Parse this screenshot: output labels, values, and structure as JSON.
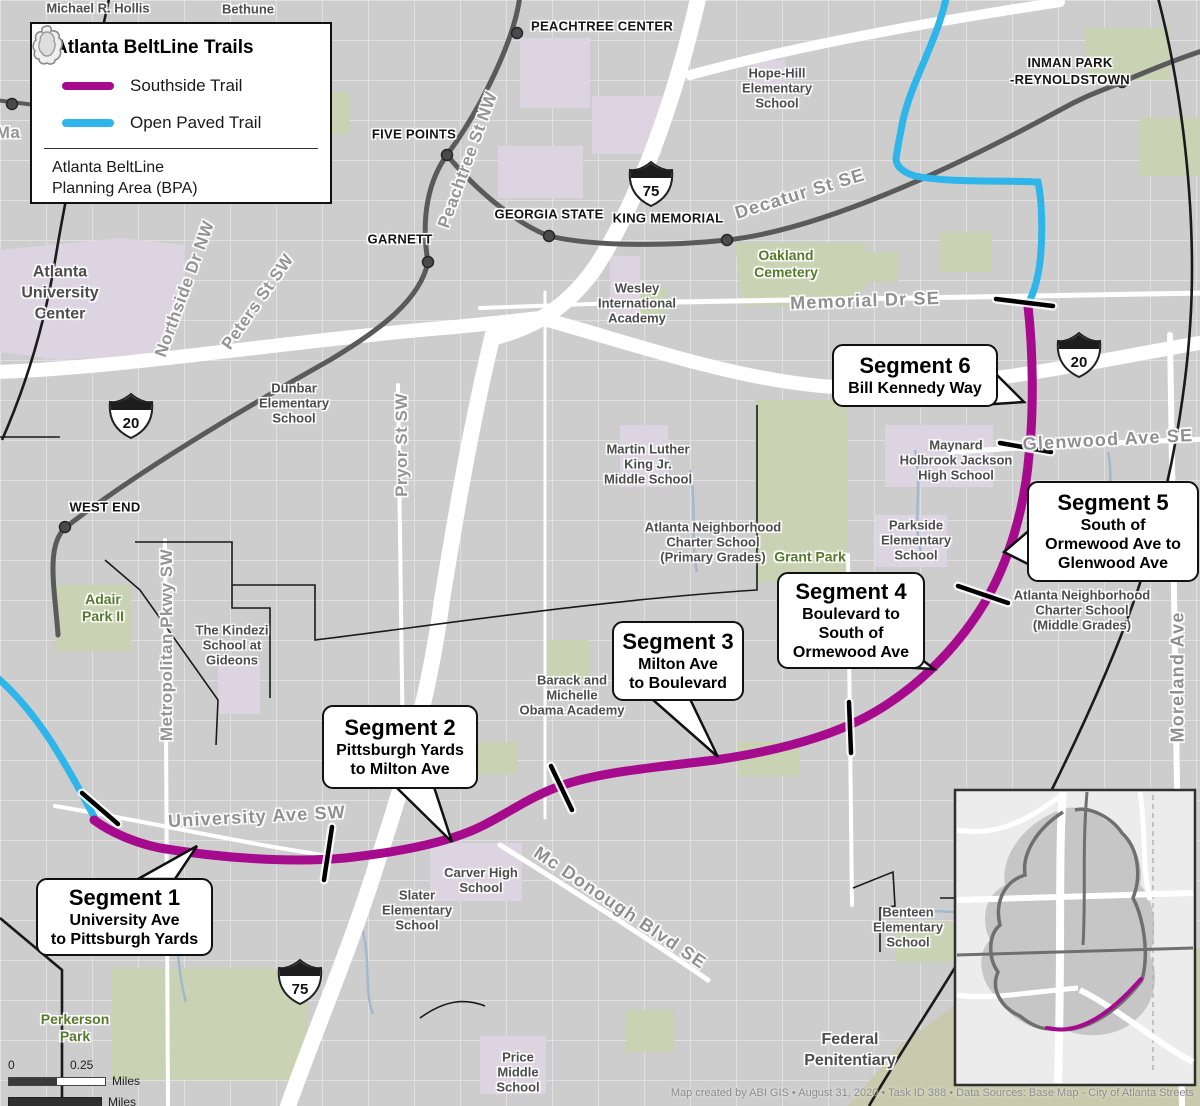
{
  "colors": {
    "magenta": "#a50b8c",
    "cyan": "#2eb6ea",
    "base_gray": "#cdcdcd",
    "lavender": "#ddd4e1",
    "park_green": "#c9d3b3",
    "khaki": "#c9caad",
    "rail_gray": "#5a5a5a",
    "boundary_black": "#1a1a1a",
    "street_label": "#949494",
    "school_label": "#4d4d4d",
    "park_label": "#567a2b",
    "creek_blue": "#a4b8cd"
  },
  "legend": {
    "title": "Atlanta BeltLine Trails",
    "items": [
      {
        "label": "Southside Trail",
        "color": "#a50b8c"
      },
      {
        "label": "Open Paved Trail",
        "color": "#2eb6ea"
      }
    ],
    "bpa_line1": "Atlanta BeltLine",
    "bpa_line2": "Planning Area (BPA)"
  },
  "scalebar": {
    "start": "0",
    "mid": "0.25",
    "unit": "Miles"
  },
  "credits": "Map created by ABI GIS • August 31, 2020 • Task ID 388 • Data Sources: Base Map - City of Atlanta Streets",
  "callouts": [
    {
      "title": "Segment 1",
      "lines": [
        "University Ave",
        "to Pittsburgh Yards"
      ],
      "x": 36,
      "y": 878,
      "w": 177,
      "h": 78,
      "pointer": [
        [
          138,
          879
        ],
        [
          175,
          879
        ],
        [
          197,
          846
        ]
      ]
    },
    {
      "title": "Segment 2",
      "lines": [
        "Pittsburgh Yards",
        "to Milton Ave"
      ],
      "x": 322,
      "y": 705,
      "w": 156,
      "h": 84,
      "pointer": [
        [
          396,
          787
        ],
        [
          434,
          787
        ],
        [
          452,
          842
        ]
      ]
    },
    {
      "title": "Segment 3",
      "lines": [
        "Milton Ave",
        "to Boulevard"
      ],
      "x": 612,
      "y": 621,
      "w": 132,
      "h": 80,
      "pointer": [
        [
          652,
          699
        ],
        [
          690,
          699
        ],
        [
          718,
          757
        ]
      ]
    },
    {
      "title": "Segment 4",
      "lines": [
        "Boulevard to",
        "South of",
        "Ormewood Ave"
      ],
      "x": 777,
      "y": 572,
      "w": 148,
      "h": 97,
      "pointer": [
        [
          878,
          666
        ],
        [
          916,
          655
        ],
        [
          934,
          669
        ]
      ]
    },
    {
      "title": "Segment 5",
      "lines": [
        "South of",
        "Ormewood Ave to",
        "Glenwood Ave"
      ],
      "x": 1027,
      "y": 481,
      "w": 172,
      "h": 101,
      "pointer": [
        [
          1032,
          528
        ],
        [
          1032,
          566
        ],
        [
          1004,
          552
        ]
      ]
    },
    {
      "title": "Segment 6",
      "lines": [
        "Bill Kennedy Way"
      ],
      "x": 832,
      "y": 344,
      "w": 166,
      "h": 63,
      "pointer": [
        [
          994,
          372
        ],
        [
          994,
          404
        ],
        [
          1024,
          402
        ]
      ]
    }
  ],
  "map": {
    "shields": [
      {
        "route": "75",
        "x": 651,
        "y": 183
      },
      {
        "route": "20",
        "x": 131,
        "y": 415
      },
      {
        "route": "20",
        "x": 1079,
        "y": 354
      },
      {
        "route": "75",
        "x": 300,
        "y": 981
      }
    ],
    "stations": [
      [
        517,
        33
      ],
      [
        447,
        155
      ],
      [
        549,
        236
      ],
      [
        727,
        240
      ],
      [
        428,
        262
      ],
      [
        65,
        527
      ],
      [
        1122,
        82
      ],
      [
        12,
        104
      ]
    ],
    "ticks": [
      [
        82,
        793,
        118,
        824
      ],
      [
        332,
        827,
        324,
        880
      ],
      [
        551,
        766,
        572,
        810
      ],
      [
        849,
        702,
        851,
        753
      ],
      [
        958,
        586,
        1008,
        603
      ],
      [
        1000,
        443,
        1051,
        452
      ],
      [
        996,
        299,
        1053,
        306
      ]
    ],
    "labels": [
      {
        "lines": [
          "Michael R. Hollis"
        ],
        "x": 98,
        "y": 8,
        "rot": 0,
        "cls": "school"
      },
      {
        "lines": [
          "Bethune"
        ],
        "x": 248,
        "y": 9,
        "rot": 0,
        "cls": "school"
      },
      {
        "lines": [
          "PEACHTREE CENTER"
        ],
        "x": 602,
        "y": 26,
        "rot": 0,
        "cls": "station"
      },
      {
        "lines": [
          "FIVE POINTS"
        ],
        "x": 414,
        "y": 134,
        "rot": 0,
        "cls": "station"
      },
      {
        "lines": [
          "GARNETT"
        ],
        "x": 400,
        "y": 239,
        "rot": 0,
        "cls": "station"
      },
      {
        "lines": [
          "GEORGIA STATE"
        ],
        "x": 549,
        "y": 214,
        "rot": 0,
        "cls": "station"
      },
      {
        "lines": [
          "KING MEMORIAL"
        ],
        "x": 668,
        "y": 218,
        "rot": 0,
        "cls": "station"
      },
      {
        "lines": [
          "WEST END"
        ],
        "x": 105,
        "y": 507,
        "rot": 0,
        "cls": "station"
      },
      {
        "lines": [
          "INMAN PARK",
          "-REYNOLDSTOWN"
        ],
        "x": 1070,
        "y": 71,
        "rot": 0,
        "cls": "station"
      },
      {
        "lines": [
          "Hope-Hill",
          "Elementary",
          "School"
        ],
        "x": 777,
        "y": 88,
        "rot": 0,
        "cls": "school"
      },
      {
        "lines": [
          "Peachtree St NW"
        ],
        "x": 468,
        "y": 160,
        "rot": -70,
        "cls": "street"
      },
      {
        "lines": [
          "Decatur St SE"
        ],
        "x": 800,
        "y": 194,
        "rot": -17,
        "cls": "street-lg"
      },
      {
        "lines": [
          "Memorial Dr SE"
        ],
        "x": 865,
        "y": 301,
        "rot": -2,
        "cls": "street-lg"
      },
      {
        "lines": [
          "Glenwood Ave SE"
        ],
        "x": 1108,
        "y": 440,
        "rot": -3,
        "cls": "street-lg"
      },
      {
        "lines": [
          "Moreland Ave"
        ],
        "x": 1178,
        "y": 677,
        "rot": -90,
        "cls": "street-lg"
      },
      {
        "lines": [
          "Northside Dr NW"
        ],
        "x": 185,
        "y": 289,
        "rot": -70,
        "cls": "street"
      },
      {
        "lines": [
          "Peters St SW"
        ],
        "x": 258,
        "y": 302,
        "rot": -55,
        "cls": "street"
      },
      {
        "lines": [
          "Pryor St SW"
        ],
        "x": 402,
        "y": 445,
        "rot": -90,
        "cls": "street"
      },
      {
        "lines": [
          "Metropolitan Pkwy SW"
        ],
        "x": 167,
        "y": 645,
        "rot": -90,
        "cls": "street"
      },
      {
        "lines": [
          "University Ave SW"
        ],
        "x": 257,
        "y": 817,
        "rot": -3,
        "cls": "street-lg"
      },
      {
        "lines": [
          "Mc Donough Blvd SE"
        ],
        "x": 620,
        "y": 908,
        "rot": 34,
        "cls": "street-lg"
      },
      {
        "lines": [
          "Atlanta",
          "University",
          "Center"
        ],
        "x": 60,
        "y": 293,
        "rot": 0,
        "cls": "area"
      },
      {
        "lines": [
          "Dunbar",
          "Elementary",
          "School"
        ],
        "x": 294,
        "y": 403,
        "rot": 0,
        "cls": "school"
      },
      {
        "lines": [
          "Wesley",
          "International",
          "Academy"
        ],
        "x": 637,
        "y": 303,
        "rot": 0,
        "cls": "school"
      },
      {
        "lines": [
          "Martin Luther",
          "King Jr.",
          "Middle School"
        ],
        "x": 648,
        "y": 464,
        "rot": 0,
        "cls": "school"
      },
      {
        "lines": [
          "Atlanta Neighborhood",
          "Charter School",
          "(Primary Grades)"
        ],
        "x": 713,
        "y": 542,
        "rot": 0,
        "cls": "school"
      },
      {
        "lines": [
          "Oakland",
          "Cemetery"
        ],
        "x": 786,
        "y": 264,
        "rot": 0,
        "cls": "park"
      },
      {
        "lines": [
          "Grant Park"
        ],
        "x": 810,
        "y": 557,
        "rot": 0,
        "cls": "park"
      },
      {
        "lines": [
          "Maynard",
          "Holbrook Jackson",
          "High School"
        ],
        "x": 956,
        "y": 460,
        "rot": 0,
        "cls": "school"
      },
      {
        "lines": [
          "Parkside",
          "Elementary",
          "School"
        ],
        "x": 916,
        "y": 540,
        "rot": 0,
        "cls": "school"
      },
      {
        "lines": [
          "Atlanta Neighborhood",
          "Charter School",
          "(Middle Grades)"
        ],
        "x": 1082,
        "y": 610,
        "rot": 0,
        "cls": "school"
      },
      {
        "lines": [
          "Barack and",
          "Michelle",
          "Obama Academy"
        ],
        "x": 572,
        "y": 695,
        "rot": 0,
        "cls": "school"
      },
      {
        "lines": [
          "The Kindezi",
          "School at",
          "Gideons"
        ],
        "x": 232,
        "y": 645,
        "rot": 0,
        "cls": "school"
      },
      {
        "lines": [
          "Adair",
          "Park II"
        ],
        "x": 103,
        "y": 608,
        "rot": 0,
        "cls": "park"
      },
      {
        "lines": [
          "Carver High",
          "School"
        ],
        "x": 481,
        "y": 880,
        "rot": 0,
        "cls": "school"
      },
      {
        "lines": [
          "Slater",
          "Elementary",
          "School"
        ],
        "x": 417,
        "y": 910,
        "rot": 0,
        "cls": "school"
      },
      {
        "lines": [
          "Benteen",
          "Elementary",
          "School"
        ],
        "x": 908,
        "y": 927,
        "rot": 0,
        "cls": "school"
      },
      {
        "lines": [
          "Price",
          "Middle",
          "School"
        ],
        "x": 518,
        "y": 1072,
        "rot": 0,
        "cls": "school"
      },
      {
        "lines": [
          "Perkerson",
          "Park"
        ],
        "x": 75,
        "y": 1028,
        "rot": 0,
        "cls": "park"
      },
      {
        "lines": [
          "Federal",
          "Penitentiary"
        ],
        "x": 850,
        "y": 1050,
        "rot": 0,
        "cls": "area"
      },
      {
        "lines": [
          "Ma"
        ],
        "x": 8,
        "y": 133,
        "rot": 0,
        "cls": "street"
      }
    ]
  }
}
